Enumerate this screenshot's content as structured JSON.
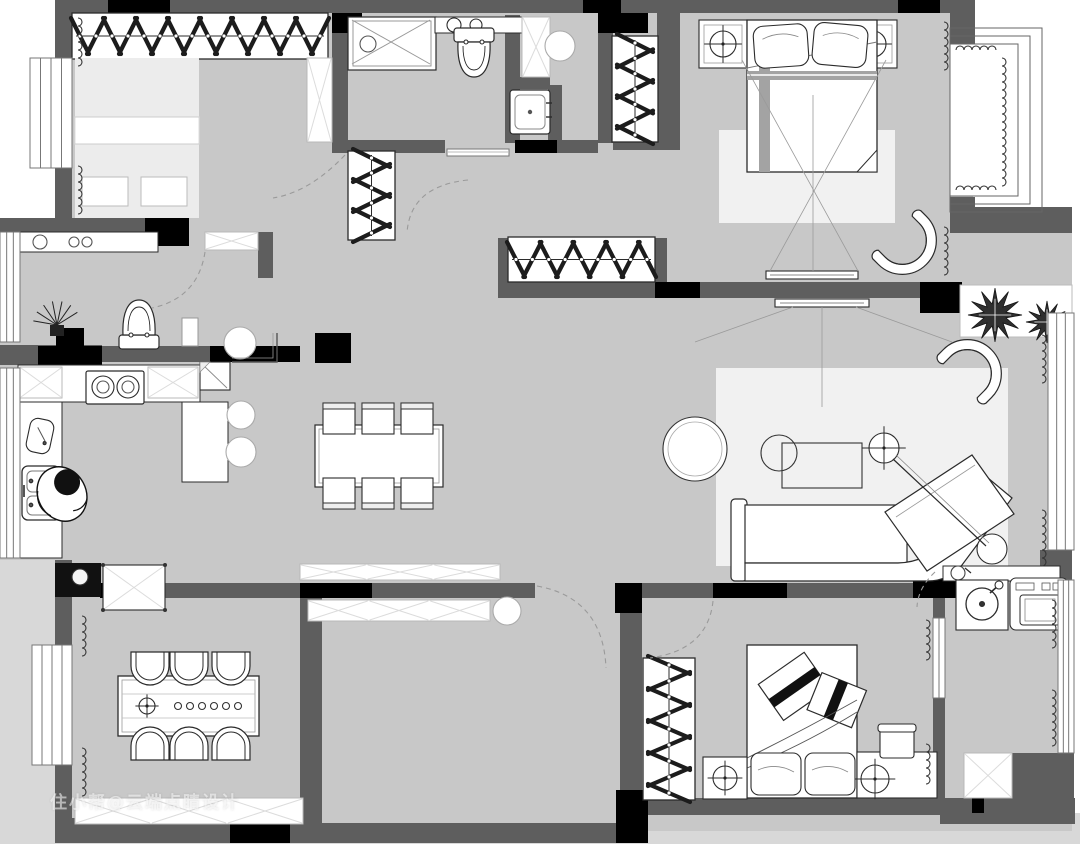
{
  "watermark": {
    "text": "住小帮@云端点睛设计"
  },
  "colors": {
    "floor": "#c8c8c8",
    "outside": "#d8d8d8",
    "wall": "#5e5e5e",
    "wall_accent": "#000000",
    "furniture_fill": "#ffffff",
    "furniture_line": "#2b2b2b",
    "soft_line": "#8f8f8f",
    "hatch_line": "#dcdcdc",
    "rug": "#f1f1f1",
    "bed_platform": "#ececec",
    "runner": "#a3a3a3",
    "plant": "#2f2f2f",
    "dash": "#9a9a9a",
    "watermark_color": "rgba(255,255,255,0.55)"
  },
  "plan": {
    "type": "apartment-floor-plan",
    "rooms": [
      {
        "id": "cloakroom-bedroom",
        "position": "top-left",
        "furniture": [
          "wardrobe-hangers",
          "platform-bed",
          "cushions",
          "storage-cabinet",
          "window",
          "curtains",
          "door-swing"
        ]
      },
      {
        "id": "bathroom",
        "position": "top-middle",
        "furniture": [
          "shower",
          "vanity-counter",
          "toilet",
          "tall-cabinet",
          "stool",
          "washbasin",
          "threshold"
        ]
      },
      {
        "id": "hallway",
        "position": "center-top",
        "furniture": [
          "closet-hangers-a",
          "closet-hangers-b",
          "closet-hangers-c",
          "shoe-cabinet",
          "pouf",
          "column",
          "door-swings"
        ]
      },
      {
        "id": "entry-powder",
        "position": "left",
        "furniture": [
          "console",
          "decor-bowls",
          "plant",
          "toilet",
          "shelf"
        ]
      },
      {
        "id": "master-bedroom",
        "position": "top-right",
        "furniture": [
          "double-bed",
          "pillows",
          "nightstand-lamp-left",
          "nightstand-lamp-right",
          "rug",
          "armchair",
          "tv",
          "sightlines",
          "bay-window",
          "curtains"
        ]
      },
      {
        "id": "living-room",
        "position": "right",
        "furniture": [
          "sofa-with-chaise",
          "coffee-table",
          "round-side-table",
          "ottoman",
          "arc-floor-lamp",
          "armchair",
          "tv",
          "rug",
          "plants",
          "window",
          "curtains"
        ]
      },
      {
        "id": "kitchen",
        "position": "left-middle",
        "furniture": [
          "l-counter",
          "upper-cabinets",
          "gas-stove",
          "double-sink",
          "person-washing",
          "cutting-board",
          "fridge",
          "bar-stools",
          "window"
        ]
      },
      {
        "id": "dining-area-center",
        "position": "center",
        "furniture": [
          "dining-table",
          "square-chairs",
          "column",
          "sideboards",
          "round-stool"
        ]
      },
      {
        "id": "dining-room",
        "position": "bottom-left",
        "furniture": [
          "dining-table",
          "round-back-chairs",
          "table-decor",
          "sideboard",
          "bar-counter-sink",
          "cabinet",
          "window",
          "curtains"
        ]
      },
      {
        "id": "second-bedroom",
        "position": "bottom-right",
        "furniture": [
          "bed",
          "pillows",
          "folded-blankets",
          "nightstand-lamp",
          "desk",
          "desk-lamp",
          "desk-chair",
          "wardrobe-hangers",
          "door-swing",
          "window",
          "curtains"
        ]
      },
      {
        "id": "laundry-balcony",
        "position": "bottom-right-corner",
        "furniture": [
          "laundry-sink",
          "washing-machine",
          "dryer",
          "storage-cabinet",
          "window",
          "curtains"
        ]
      }
    ]
  }
}
